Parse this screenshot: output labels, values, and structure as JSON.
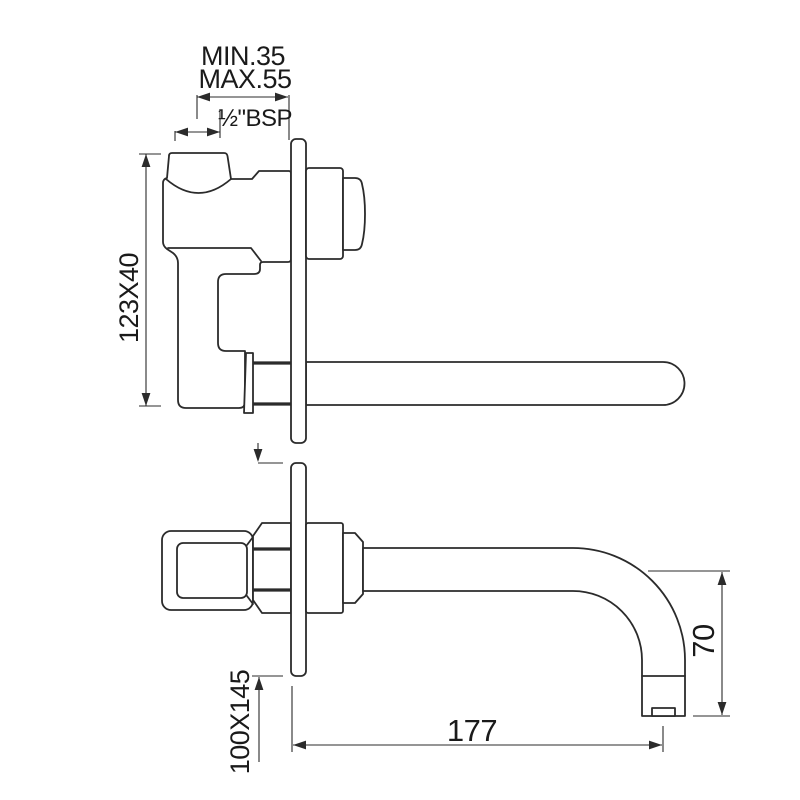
{
  "drawing": {
    "title": "wall-mounted-basin-mixer-dimension-drawing",
    "labels": {
      "min_depth": "MIN.35",
      "max_depth": "MAX.55",
      "thread": "½\"BSP",
      "body_size": "123X40",
      "plate_size": "100X145",
      "spout_reach": "177",
      "spout_drop": "70"
    },
    "colors": {
      "line": "#2b2b2b",
      "text": "#1a1a1a",
      "background": "#ffffff"
    }
  }
}
